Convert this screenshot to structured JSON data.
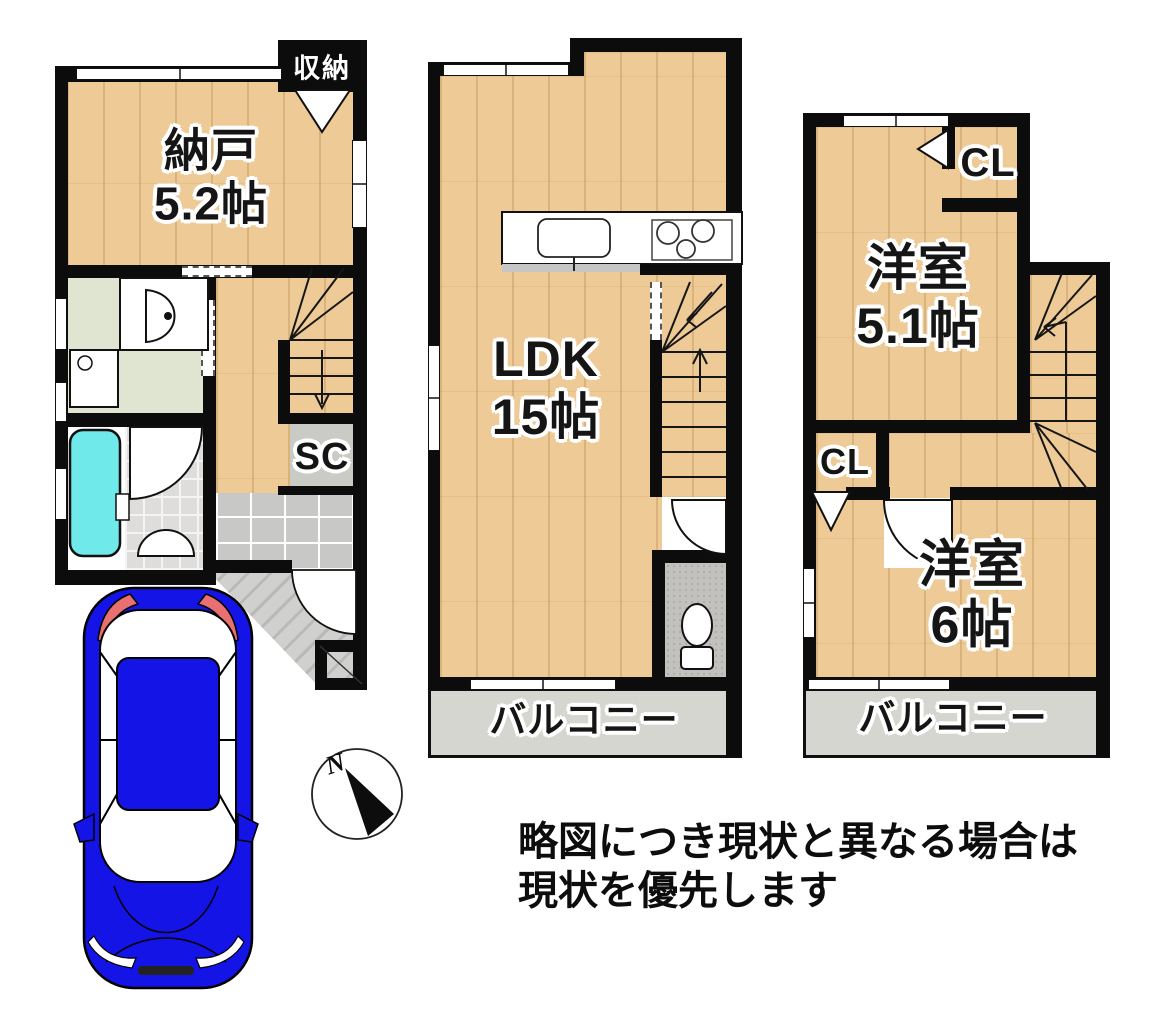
{
  "floor1": {
    "closet_label": "収納",
    "room_name": "納戸",
    "room_size": "5.2帖",
    "shoe_closet_label": "SC"
  },
  "floor2": {
    "room_name": "LDK",
    "room_size": "15帖",
    "balcony_label": "バルコニー"
  },
  "floor3": {
    "room1_name": "洋室",
    "room1_size": "5.1帖",
    "closet_top_label": "CL",
    "closet_side_label": "CL",
    "room2_name": "洋室",
    "room2_size": "6帖",
    "balcony_label": "バルコニー"
  },
  "compass": {
    "north_label": "N"
  },
  "note": {
    "line1": "略図につき現状と異なる場合は",
    "line2": "現状を優先します"
  },
  "colors": {
    "wall": "#0c0c0c",
    "wood": "#edca96",
    "washroom_floor": "#e0e5d2",
    "tile_floor": "#c8c8c7",
    "sc_floor": "#cbcbc5",
    "toilet_floor": "#c2c1be",
    "balcony_floor": "#d6d6d1",
    "bathtub": "#6fe9ea",
    "car_body": "#1414e6",
    "car_accent": "#e87070"
  }
}
